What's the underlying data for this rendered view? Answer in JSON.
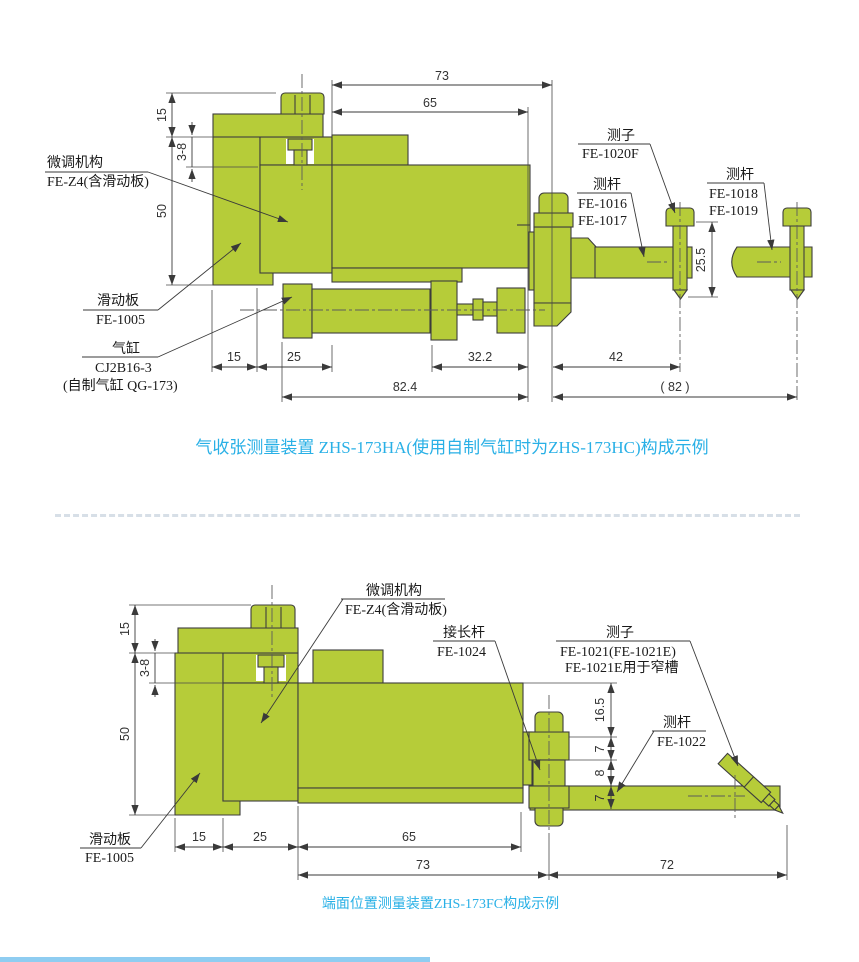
{
  "colors": {
    "part_green": "#b6cc39",
    "outline": "#3d3d3d",
    "caption_blue": "#29b0e6",
    "dim_text": "#333333",
    "separator": "#d7dfe7",
    "bottom_bar_blue": "#8fcdf1"
  },
  "diagram1": {
    "caption": "气收张测量装置 ZHS-173HA(使用自制气缸时为ZHS-173HC)构成示例",
    "labels": {
      "fine_adjust": {
        "title": "微调机构",
        "part_no": "FE-Z4(含滑动板)"
      },
      "slide_plate": {
        "title": "滑动板",
        "part_no": "FE-1005"
      },
      "cylinder": {
        "title": "气缸",
        "part_no": "CJ2B16-3",
        "note": "(自制气缸 QG-173)"
      },
      "stylus": {
        "title": "测子",
        "part_no": "FE-1020F"
      },
      "rod_a": {
        "title": "测杆",
        "part_no_1": "FE-1016",
        "part_no_2": "FE-1017"
      },
      "rod_b": {
        "title": "测杆",
        "part_no_1": "FE-1018",
        "part_no_2": "FE-1019"
      }
    },
    "dims": {
      "d73": "73",
      "d65": "65",
      "d15_left": "15",
      "d38": "3-8",
      "d50": "50",
      "d25_5": "25.5",
      "d15": "15",
      "d25": "25",
      "d32_2": "32.2",
      "d82_4": "82.4",
      "d42": "42",
      "d82": "( 82 )"
    }
  },
  "diagram2": {
    "caption": "端面位置测量装置ZHS-173FC构成示例",
    "labels": {
      "fine_adjust": {
        "title": "微调机构",
        "part_no": "FE-Z4(含滑动板)"
      },
      "extension_rod": {
        "title": "接长杆",
        "part_no": "FE-1024"
      },
      "stylus": {
        "title": "测子",
        "part_no": "FE-1021(FE-1021E)",
        "note": "FE-1021E用于窄槽"
      },
      "rod": {
        "title": "测杆",
        "part_no": "FE-1022"
      },
      "slide_plate": {
        "title": "滑动板",
        "part_no": "FE-1005"
      }
    },
    "dims": {
      "d15_left": "15",
      "d38": "3-8",
      "d50": "50",
      "d16_5": "16.5",
      "d7a": "7",
      "d8": "8",
      "d7b": "7",
      "d15": "15",
      "d25": "25",
      "d65": "65",
      "d73": "73",
      "d72": "72"
    }
  }
}
